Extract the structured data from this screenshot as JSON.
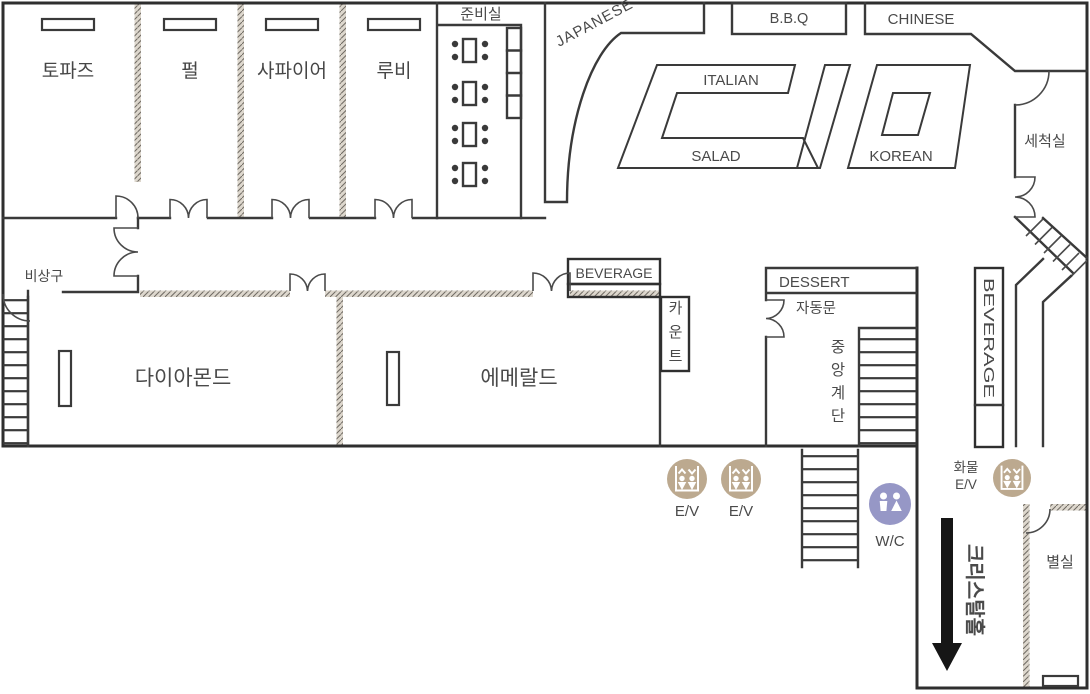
{
  "floorplan": {
    "rooms": {
      "topaz": "토파즈",
      "pearl": "펄",
      "sapphire": "사파이어",
      "ruby": "루비",
      "prep": "준비실",
      "diamond": "다이아몬드",
      "emerald": "에메랄드",
      "washroom": "세척실",
      "annex": "별실"
    },
    "buffet": {
      "japanese": "JAPANESE",
      "bbq": "B.B.Q",
      "chinese": "CHINESE",
      "italian": "ITALIAN",
      "salad": "SALAD",
      "korean": "KOREAN",
      "beverage_top": "BEVERAGE",
      "beverage_side": "BEVERAGE",
      "dessert": "DESSERT",
      "counter": "카운트"
    },
    "circulation": {
      "emergency_exit": "비상구",
      "auto_door": "자동문",
      "central_stair": "중앙계단",
      "crystal_hall": "크리스탈홀",
      "ev1": "E/V",
      "ev2": "E/V",
      "cargo_label": "화물",
      "cargo_ev": "E/V",
      "wc": "W/C"
    },
    "colors": {
      "wall": "#3a3a3a",
      "label": "#4a4a4a",
      "elevator_icon": "#bca98f",
      "wc_icon": "#9697c6",
      "arrow": "#161616",
      "hatch_fill": "#ddd7cd"
    }
  }
}
